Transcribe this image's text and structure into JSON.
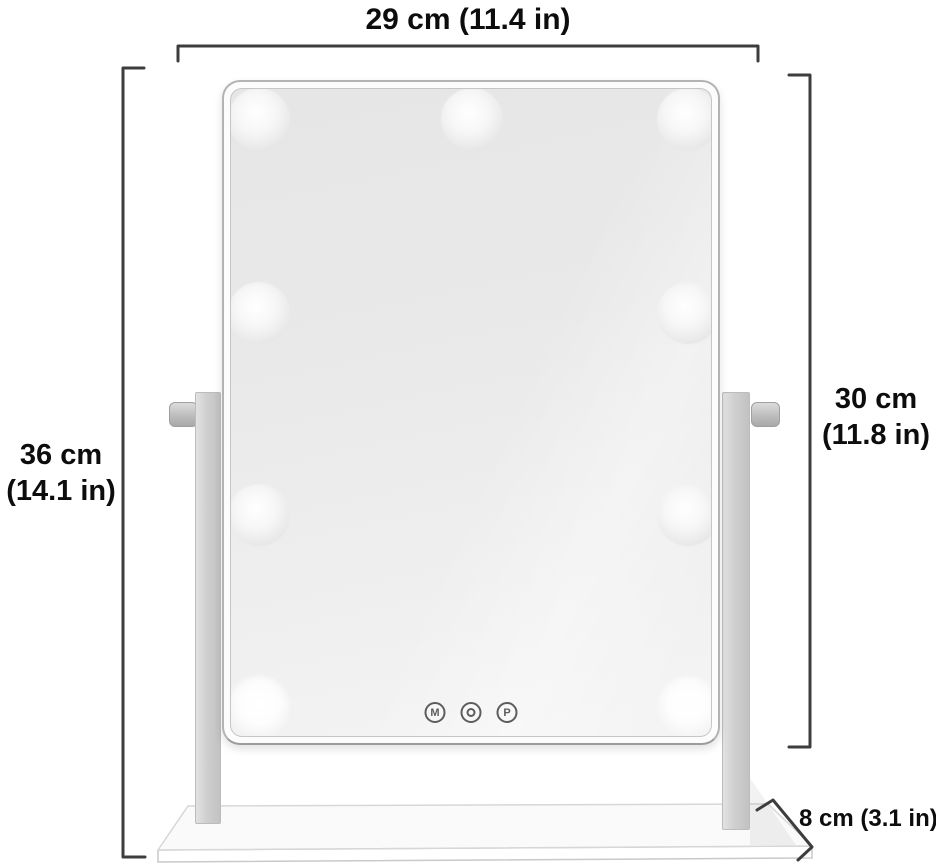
{
  "diagram": {
    "kind": "product-dimension-diagram",
    "product": "lighted vanity mirror with swivel stand"
  },
  "labels": {
    "width": "29 cm (11.4 in)",
    "overall_height_line1": "36 cm",
    "overall_height_line2": "(14.1 in)",
    "mirror_height_line1": "30 cm",
    "mirror_height_line2": "(11.8 in)",
    "depth": "8 cm (3.1 in)"
  },
  "mirror": {
    "bulb_count": 9,
    "bulb_rows": [
      3,
      2,
      2,
      2
    ],
    "buttons": {
      "left_label": "M",
      "center_icon": "power-ring-icon",
      "right_label": "P"
    }
  },
  "colors": {
    "background": "#ffffff",
    "dimension_line": "#3d3d3d",
    "label_text": "#0d0d0d",
    "frame_border": "#b3b3b3",
    "mirror_surface_dark": "#e6e6e6",
    "mirror_surface_light": "#f5f5f5",
    "stand_metal": "#c9c9c9",
    "button_ring": "#5d5d5d"
  }
}
